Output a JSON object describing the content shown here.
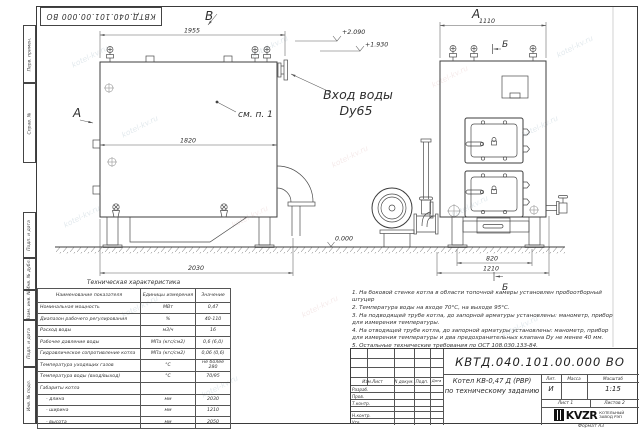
{
  "watermark": "kotel-kv.ru",
  "stamp_top": "КВТД.040.101.00.000 ВО",
  "margin": {
    "labels": [
      "Перв. примен.",
      "Справ. №",
      "Подп. и дата",
      "Инв. № дубл.",
      "Взам. инв. №",
      "Подп. и дата",
      "Инв. № подл."
    ]
  },
  "views": {
    "side": {
      "view_label": "В",
      "arrow_label": "А",
      "dim_top": "1955",
      "dim_inner": "1820",
      "dim_bottom": "2030",
      "level_top": "+2.090",
      "level_inlet": "+1.930",
      "level_ground": "0.000",
      "see_note": "см. п. 1",
      "inlet_title": "Вход воды",
      "inlet_dn": "Dy65"
    },
    "front": {
      "view_label": "А",
      "section_top": "Б",
      "section_bottom": "Б",
      "dim_top": "1110",
      "dim_legs": "820",
      "dim_overall": "1210"
    }
  },
  "spec_table": {
    "title": "Техническая характеристика",
    "headers": [
      "Наименование показателя",
      "Единицы измерения",
      "Значение"
    ],
    "rows": [
      [
        "Номинальная мощность",
        "МВт",
        "0,47"
      ],
      [
        "Диапазон рабочего регулирования",
        "%",
        "40-110"
      ],
      [
        "Расход воды",
        "м3/ч",
        "16"
      ],
      [
        "Рабочее давление воды",
        "МПа (кгс/см2)",
        "0,6 (6,0)"
      ],
      [
        "Гидравлическое сопротивление котла",
        "МПа (кгс/см2)",
        "0,06 (0,6)"
      ],
      [
        "Температура уходящих газов",
        "°С",
        "не более 280"
      ],
      [
        "Температура воды (вход/выход)",
        "°С",
        "70/95"
      ],
      [
        "Габариты котла",
        "",
        ""
      ],
      [
        "- длина",
        "мм",
        "2030"
      ],
      [
        "- ширина",
        "мм",
        "1210"
      ],
      [
        "- высота",
        "мм",
        "2050"
      ]
    ]
  },
  "notes": [
    "1. На боковой стенке котла в области топочной камеры установлен пробоотборный штуцер",
    "2. Температура воды на входе 70°С, на выходе 95°С.",
    "3. На подводящей трубе котла, до запорной арматуры установлены: манометр, прибор для измерения температуры.",
    "4. На отводящей трубе котла, до запорной арматуры установлены: манометр, прибор для измерения температуры и два предохранительных клапана Dу не менее 40 мм.",
    "5. Остальные технические требования по ОСТ 108.030.133-84."
  ],
  "title_block": {
    "doc_number": "КВТД.040.101.00.000 ВО",
    "columns_header": [
      "Изм.Лист",
      "N докум.",
      "Подп.",
      "Дата"
    ],
    "roles": [
      "Разраб.",
      "Пров.",
      "Т.контр.",
      "Н.контр.",
      "Утв."
    ],
    "product_title_1": "Котел КВ-0,47 Д (РВР)",
    "product_title_2": "по техническому заданию",
    "lit_label": "Лит.",
    "mass_label": "Масса",
    "scale_label": "Масштаб",
    "lit_value": "И",
    "scale_value": "1:15",
    "sheet_label": "Лист 1",
    "sheets_label": "Листов 2",
    "logo_text": "KVZR",
    "logo_caption_1": "КОТЕЛЬНЫЙ",
    "logo_caption_2": "ЗАВОД РЭП",
    "format_label": "Формат  А3"
  }
}
